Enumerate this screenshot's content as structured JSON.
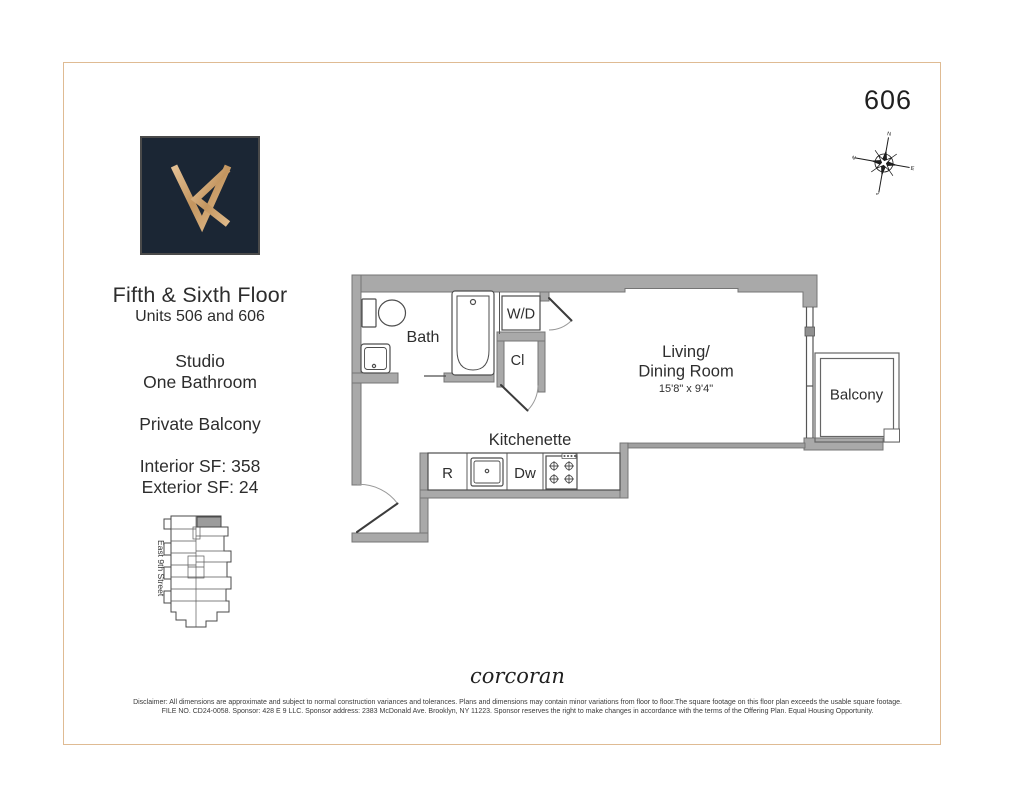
{
  "header": {
    "unit_number": "606"
  },
  "info": {
    "title": "Fifth & Sixth Floor",
    "subtitle": "Units 506 and 606",
    "unit_type": "Studio",
    "bath_count": "One Bathroom",
    "feature": "Private Balcony",
    "interior_sf": "Interior SF: 358",
    "exterior_sf": "Exterior SF: 24"
  },
  "key_plan": {
    "street_label": "East 9th Street"
  },
  "compass": {
    "north": "N",
    "east": "E",
    "south": "S",
    "west": "W"
  },
  "floor_plan": {
    "labels": {
      "bath": "Bath",
      "washer_dryer": "W/D",
      "closet": "Cl",
      "living_line1": "Living/",
      "living_line2": "Dining Room",
      "living_dims": "15'8\" x 9'4\"",
      "balcony": "Balcony",
      "kitchenette": "Kitchenette",
      "refrigerator": "R",
      "dishwasher": "Dw"
    }
  },
  "footer": {
    "brand": "corcoran",
    "disclaimer_line1": "Disclaimer: All dimensions are approximate and subject to normal construction variances and tolerances. Plans and dimensions may contain minor variations from floor to floor.The square footage on this floor plan exceeds the usable square footage.",
    "disclaimer_line2": "FILE NO. CD24-0058. Sponsor: 428 E 9 LLC. Sponsor address: 2383 McDonald Ave. Brooklyn, NY 11223. Sponsor reserves the right to make changes in accordance with the terms of the Offering Plan. Equal Housing Opportunity."
  },
  "colors": {
    "wall": "#a9a9a9",
    "frame": "#dfbb93",
    "logo_background": "#1b2634",
    "logo_gold": "#cfa26c",
    "key_unit_highlight": "#9c9c9c"
  }
}
